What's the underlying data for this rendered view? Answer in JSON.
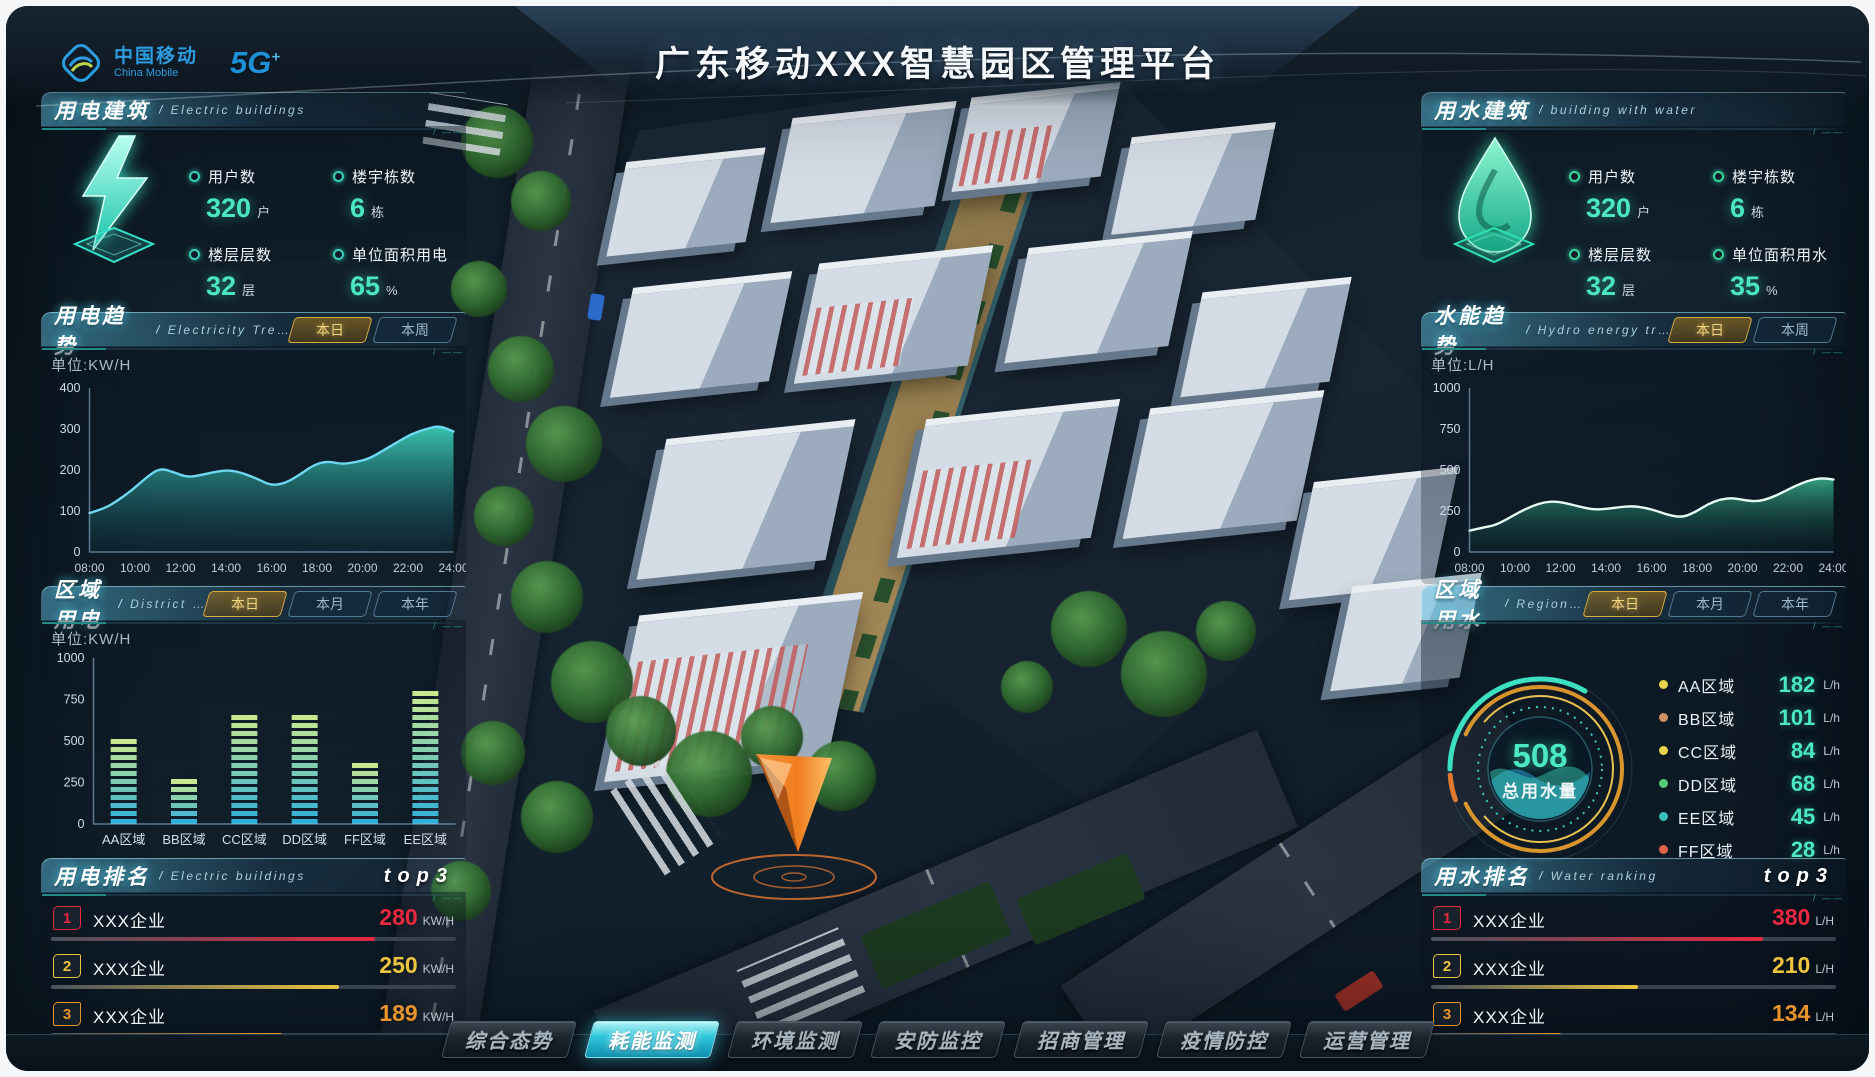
{
  "header": {
    "logo_cn": "中国移动",
    "logo_en": "China Mobile",
    "logo_5g": "5G",
    "logo_5g_plus": "+",
    "title": "广东移动XXX智慧园区管理平台"
  },
  "panels": {
    "electric_building": {
      "title": "用电建筑",
      "subtitle": "Electric buildings",
      "stats": [
        {
          "label": "用户数",
          "value": "320",
          "unit": "户"
        },
        {
          "label": "楼宇栋数",
          "value": "6",
          "unit": "栋"
        },
        {
          "label": "楼层层数",
          "value": "32",
          "unit": "层"
        },
        {
          "label": "单位面积用电",
          "value": "65",
          "unit": "%"
        }
      ]
    },
    "electric_trend": {
      "title": "用电趋势",
      "subtitle": "Electricity Trend",
      "tabs": [
        "本日",
        "本周"
      ],
      "active_tab": 0,
      "unit_label": "单位:KW/H"
    },
    "district_electric": {
      "title": "区域用电",
      "subtitle": "District electricity",
      "tabs": [
        "本日",
        "本月",
        "本年"
      ],
      "active_tab": 0,
      "unit_label": "单位:KW/H"
    },
    "electric_rank": {
      "title": "用电排名",
      "subtitle": "Electric buildings",
      "top_label": "top3",
      "rows": [
        {
          "rank": "1",
          "name": "XXX企业",
          "value": "280",
          "unit": "KW/H",
          "percent": 80,
          "color": "#e82840"
        },
        {
          "rank": "2",
          "name": "XXX企业",
          "value": "250",
          "unit": "KW/H",
          "percent": 71,
          "color": "#ecc440"
        },
        {
          "rank": "3",
          "name": "XXX企业",
          "value": "189",
          "unit": "KW/H",
          "percent": 57,
          "color": "#e8942c"
        }
      ]
    },
    "water_building": {
      "title": "用水建筑",
      "subtitle": "building with water",
      "stats": [
        {
          "label": "用户数",
          "value": "320",
          "unit": "户"
        },
        {
          "label": "楼宇栋数",
          "value": "6",
          "unit": "栋"
        },
        {
          "label": "楼层层数",
          "value": "32",
          "unit": "层"
        },
        {
          "label": "单位面积用水",
          "value": "35",
          "unit": "%"
        }
      ]
    },
    "water_trend": {
      "title": "水能趋势",
      "subtitle": "Hydro energy trends",
      "tabs": [
        "本日",
        "本周"
      ],
      "active_tab": 0,
      "unit_label": "单位:L/H"
    },
    "regional_water": {
      "title": "区域用水",
      "subtitle": "Regional water",
      "tabs": [
        "本日",
        "本月",
        "本年"
      ],
      "active_tab": 0,
      "gauge": {
        "value": "508",
        "label": "总用水量"
      },
      "legend": [
        {
          "name": "AA区域",
          "value": "182",
          "unit": "L/h",
          "color": "#e8d44d"
        },
        {
          "name": "BB区域",
          "value": "101",
          "unit": "L/h",
          "color": "#cf8f62"
        },
        {
          "name": "CC区域",
          "value": "84",
          "unit": "L/h",
          "color": "#e8d44d"
        },
        {
          "name": "DD区域",
          "value": "68",
          "unit": "L/h",
          "color": "#58c878"
        },
        {
          "name": "EE区域",
          "value": "45",
          "unit": "L/h",
          "color": "#38c0b8"
        },
        {
          "name": "FF区域",
          "value": "28",
          "unit": "L/h",
          "color": "#e06448"
        }
      ]
    },
    "water_rank": {
      "title": "用水排名",
      "subtitle": "Water ranking",
      "top_label": "top3",
      "rows": [
        {
          "rank": "1",
          "name": "XXX企业",
          "value": "380",
          "unit": "L/H",
          "percent": 82,
          "color": "#e82840"
        },
        {
          "rank": "2",
          "name": "XXX企业",
          "value": "210",
          "unit": "L/H",
          "percent": 51,
          "color": "#ecc440"
        },
        {
          "rank": "3",
          "name": "XXX企业",
          "value": "134",
          "unit": "L/H",
          "percent": 32,
          "color": "#e8942c"
        }
      ]
    }
  },
  "nav": {
    "tabs": [
      {
        "label": "综合态势",
        "active": false
      },
      {
        "label": "耗能监测",
        "active": true
      },
      {
        "label": "环境监测",
        "active": false
      },
      {
        "label": "安防监控",
        "active": false
      },
      {
        "label": "招商管理",
        "active": false
      },
      {
        "label": "疫情防控",
        "active": false
      },
      {
        "label": "运营管理",
        "active": false
      }
    ]
  },
  "chart_data": [
    {
      "id": "electric-trend-chart",
      "type": "area",
      "title": "用电趋势 本日",
      "ylabel": "KW/H",
      "x_labels": [
        "08:00",
        "10:00",
        "12:00",
        "14:00",
        "16:00",
        "18:00",
        "20:00",
        "22:00",
        "24:00"
      ],
      "values": [
        95,
        105,
        125,
        150,
        180,
        205,
        195,
        182,
        188,
        196,
        200,
        192,
        178,
        162,
        168,
        188,
        212,
        222,
        214,
        219,
        228,
        248,
        268,
        288,
        300,
        308,
        294
      ],
      "ylim": [
        0,
        400
      ],
      "yticks": [
        0,
        100,
        200,
        300,
        400
      ],
      "line_color": "#6fd8f0",
      "fill_top": "rgba(62,224,198,0.85)",
      "fill_bottom": "rgba(22,86,104,0.12)"
    },
    {
      "id": "water-trend-chart",
      "type": "area",
      "title": "水能趋势 本日",
      "ylabel": "L/H",
      "x_labels": [
        "08:00",
        "10:00",
        "12:00",
        "14:00",
        "16:00",
        "18:00",
        "20:00",
        "22:00",
        "24:00"
      ],
      "values": [
        130,
        148,
        162,
        200,
        245,
        280,
        305,
        308,
        292,
        272,
        258,
        264,
        274,
        280,
        270,
        248,
        222,
        212,
        244,
        292,
        322,
        330,
        314,
        308,
        330,
        365,
        405,
        435,
        452,
        442
      ],
      "ylim": [
        0,
        1000
      ],
      "yticks": [
        0,
        250,
        500,
        750,
        1000
      ],
      "line_color": "#e6fbf2",
      "fill_top": "rgba(62,190,150,0.8)",
      "fill_bottom": "rgba(8,52,52,0.1)"
    },
    {
      "id": "district-electric-chart",
      "type": "bar",
      "title": "区域用电 本日",
      "ylabel": "KW/H",
      "categories": [
        "AA区域",
        "BB区域",
        "CC区域",
        "DD区域",
        "FF区域",
        "EE区域"
      ],
      "values": [
        560,
        290,
        690,
        720,
        430,
        855
      ],
      "ylim": [
        0,
        1000
      ],
      "yticks": [
        0,
        250,
        500,
        750,
        1000
      ],
      "bar_bottom_color": "#2fb0d8",
      "bar_top_color": "#c8e890"
    },
    {
      "id": "water-gauge",
      "type": "gauge",
      "value": 508,
      "label": "总用水量",
      "units": "L/h",
      "legend": [
        {
          "name": "AA区域",
          "value": 182
        },
        {
          "name": "BB区域",
          "value": 101
        },
        {
          "name": "CC区域",
          "value": 84
        },
        {
          "name": "DD区域",
          "value": 68
        },
        {
          "name": "EE区域",
          "value": 45
        },
        {
          "name": "FF区域",
          "value": 28
        }
      ]
    }
  ]
}
